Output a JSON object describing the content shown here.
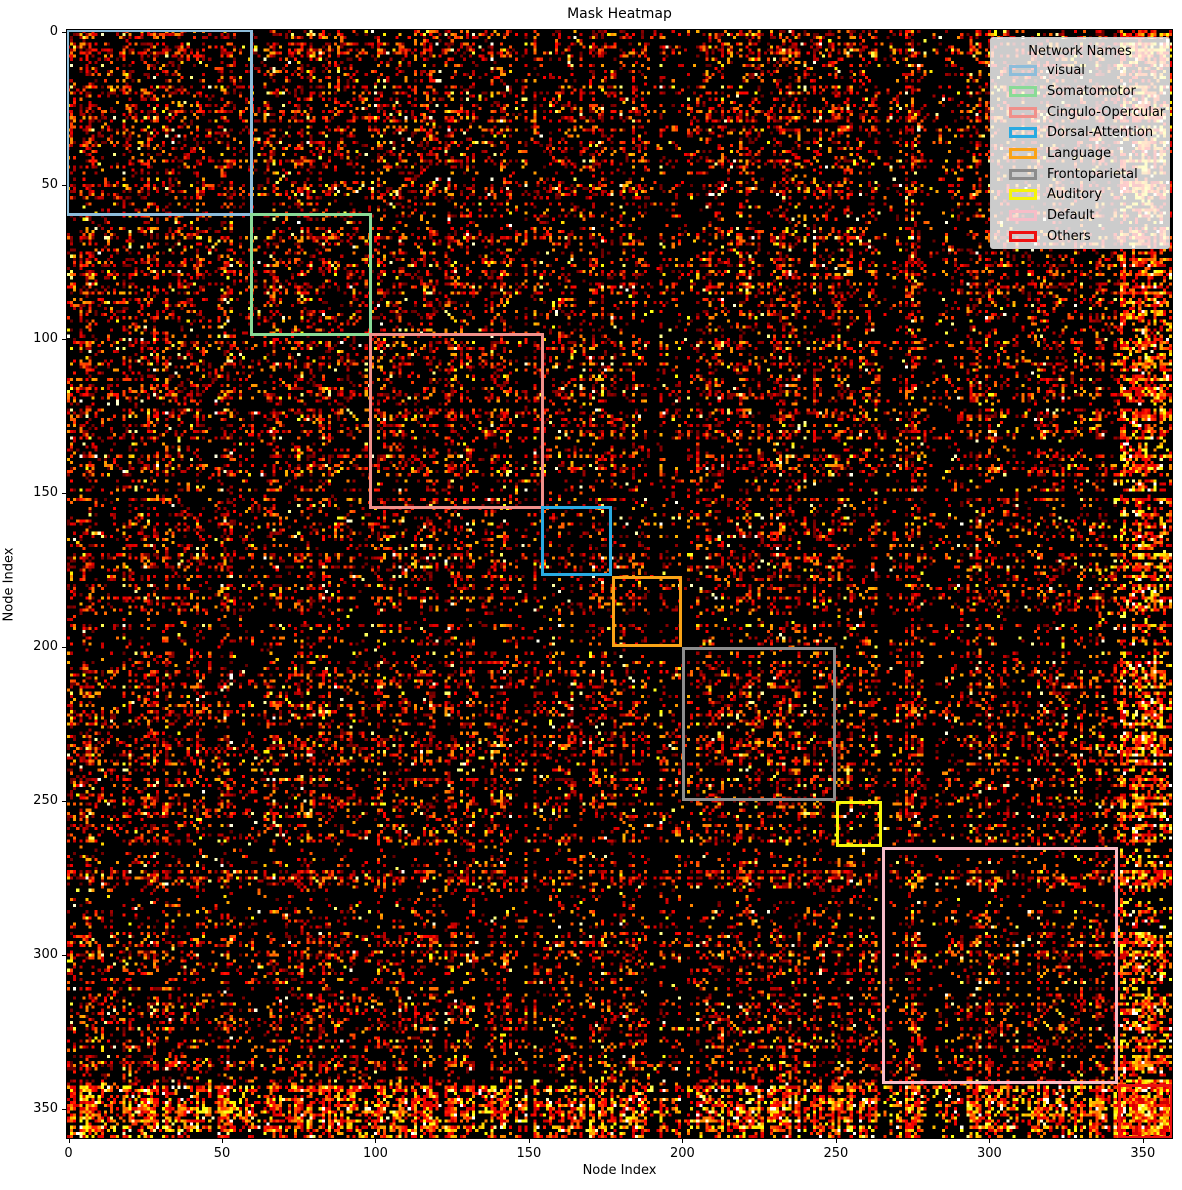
{
  "title": "Mask Heatmap",
  "axes": {
    "xlabel": "Node Index",
    "ylabel": "Node Index",
    "xticks": [
      0,
      50,
      100,
      150,
      200,
      250,
      300,
      350
    ],
    "yticks": [
      0,
      50,
      100,
      150,
      200,
      250,
      300,
      350
    ]
  },
  "legend": {
    "title": "Network Names",
    "items": [
      {
        "label": "visual",
        "color": "#8dbdda"
      },
      {
        "label": "Somatomotor",
        "color": "#89db96"
      },
      {
        "label": "Cingulo-Opercular",
        "color": "#f0908a"
      },
      {
        "label": "Dorsal-Attention",
        "color": "#29aae1"
      },
      {
        "label": "Language",
        "color": "#faa316"
      },
      {
        "label": "Frontoparietal",
        "color": "#8c8c8c"
      },
      {
        "label": "Auditory",
        "color": "#f5f50a"
      },
      {
        "label": "Default",
        "color": "#f7bdc8"
      },
      {
        "label": "Others",
        "color": "#ee1111"
      }
    ]
  },
  "chart_data": {
    "type": "heatmap",
    "title": "Mask Heatmap",
    "xlabel": "Node Index",
    "ylabel": "Node Index",
    "matrix_size": 360,
    "xlim": [
      0,
      360
    ],
    "ylim": [
      360,
      0
    ],
    "colormap": "hot",
    "background_color": "#000000",
    "description": "Sparse symmetric binary-like mask over a 360-node connectome; nonzero entries colored by magnitude on the 'hot' colormap (dark red to yellow), zeros black. Diagonal outlined blocks mark network membership ranges.",
    "networks": [
      {
        "name": "visual",
        "start": 0,
        "end": 60,
        "color": "#8dbdda"
      },
      {
        "name": "Somatomotor",
        "start": 60,
        "end": 99,
        "color": "#89db96"
      },
      {
        "name": "Cingulo-Opercular",
        "start": 99,
        "end": 155,
        "color": "#f0908a"
      },
      {
        "name": "Dorsal-Attention",
        "start": 155,
        "end": 177,
        "color": "#29aae1"
      },
      {
        "name": "Language",
        "start": 178,
        "end": 200,
        "color": "#faa316"
      },
      {
        "name": "Frontoparietal",
        "start": 201,
        "end": 250,
        "color": "#8c8c8c"
      },
      {
        "name": "Auditory",
        "start": 251,
        "end": 265,
        "color": "#f5f50a"
      },
      {
        "name": "Default",
        "start": 266,
        "end": 342,
        "color": "#f7bdc8"
      },
      {
        "name": "Others",
        "start": 343,
        "end": 360,
        "color": "#ee1111"
      }
    ],
    "texture": {
      "seed": 20240613,
      "base_density": 0.3,
      "dark_streak_chance": 0.06,
      "dark_streak_weight": 0.18,
      "others_density_boost": 2.2,
      "others_value_boost": 0.15,
      "visual_density_boost": 1.15,
      "dark_bands": [
        [
          265,
          272
        ],
        [
          278,
          286
        ]
      ],
      "bright_band": [
        273,
        277
      ],
      "high_value_chance": 0.1,
      "white_chance": 0.012
    }
  }
}
